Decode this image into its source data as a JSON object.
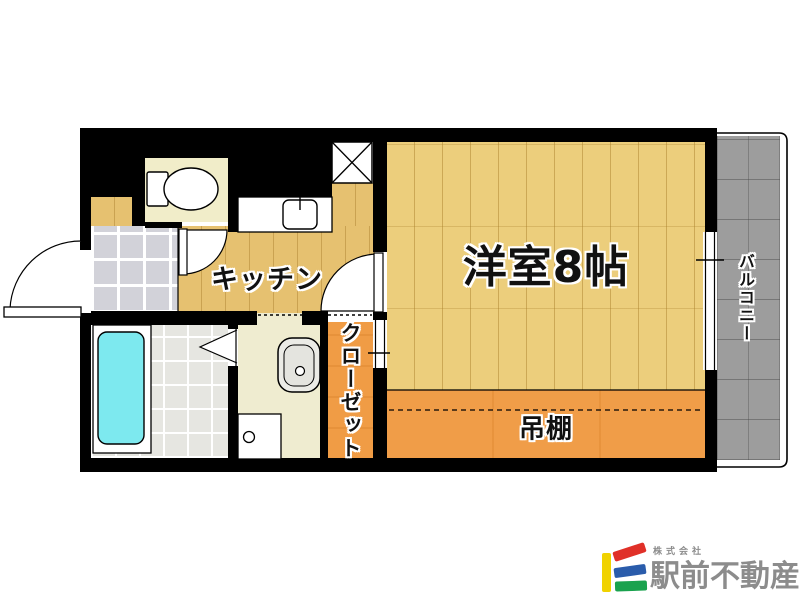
{
  "floor_plan": {
    "main_room_label": "洋室8帖",
    "kitchen_label": "キッチン",
    "closet_label": "クローゼット",
    "shelf_label": "吊棚",
    "balcony_label": "バルコニー",
    "colors": {
      "wall_black": "#000000",
      "main_room_wood": "#ecce7c",
      "kitchen_wood": "#e6c170",
      "closet_orange": "#f09c45",
      "shelf_orange": "#f09d48",
      "bathtub_cyan": "#7de9ef",
      "balcony_gray": "#9d9d9d",
      "entrance_tile": "#d2d2d9",
      "washroom_cream": "#efecd0",
      "toilet_cream": "#f1edc9"
    }
  },
  "branding": {
    "company_prefix": "株式会社",
    "company_name": "駅前不動産",
    "text_color": "#8c8c8c",
    "logo_colors": {
      "yellow": "#f0d200",
      "red": "#e03028",
      "blue": "#2a5cab",
      "green": "#1aa24e"
    }
  }
}
